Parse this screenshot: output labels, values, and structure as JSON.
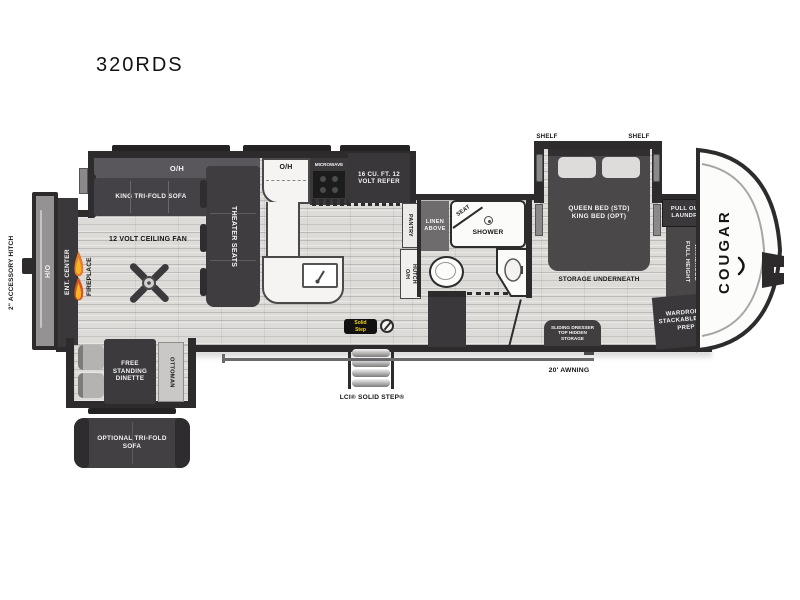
{
  "model": "320RDS",
  "brand": "COUGAR",
  "colors": {
    "wall": "#2d2b2c",
    "furniture": "#413e41",
    "floor": "#dcdbd8",
    "flame_orange": "#e87a2e",
    "badge_yellow": "#f0d11e"
  },
  "labels": {
    "hitch": "2\" ACCESSORY HITCH",
    "ho": "H/O",
    "ent_center": "ENT. CENTER",
    "fireplace": "FIREPLACE",
    "oh_living": "O/H",
    "king_sofa": "KING TRI-FOLD SOFA",
    "theater": "THEATER SEATS",
    "fan": "12 VOLT CEILING FAN",
    "oh_kitchen": "O/H",
    "microwave": "MICROWAVE",
    "refer": "16 CU. FT. 12 VOLT REFER",
    "pantry": "PANTRY",
    "hutch_oh": "O/H",
    "hutch": "HUTCH",
    "linen": "LINEN ABOVE",
    "seat": "SEAT",
    "shower": "SHOWER",
    "shelf_left": "SHELF",
    "shelf_right": "SHELF",
    "bed_line1": "QUEEN BED (STD)",
    "bed_line2": "KING BED (OPT)",
    "storage": "STORAGE UNDERNEATH",
    "laundry": "PULL OUT LAUNDRY",
    "fh_wardrobe1": "FULL HEIGHT",
    "fh_wardrobe2": "WARDROBE",
    "wardrobe_stack": "WARDROBE STACKABLE W/D PREP",
    "dresser": "SLIDING DRESSER TOP HIDDEN STORAGE",
    "dinette": "FREE STANDING DINETTE",
    "ottoman": "OTTOMAN",
    "opt_sofa": "OPTIONAL TRI-FOLD SOFA",
    "awning": "20' AWNING",
    "solid_step": "LCI® SOLID STEP®",
    "badge_line1": "Solid",
    "badge_line2": "Step"
  }
}
